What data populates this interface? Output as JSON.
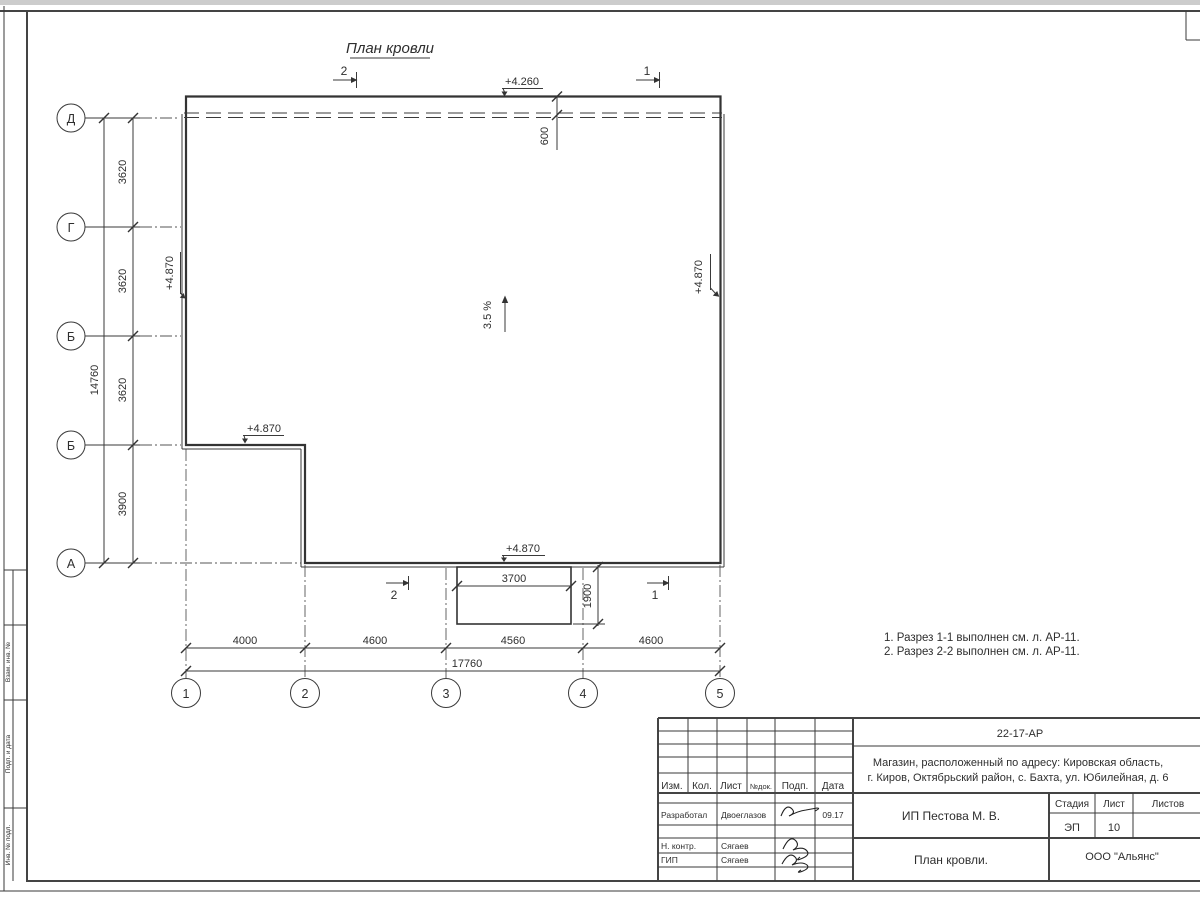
{
  "frame": {
    "side_labels": [
      "Взам. инв. №",
      "Подп. и дата",
      "Инв. № подл."
    ]
  },
  "drawing": {
    "title": "План кровли",
    "slope": "3.5 %",
    "notes": [
      "1. Разрез 1-1 выполнен см. л. АР-11.",
      "2. Разрез 2-2 выполнен см. л. АР-11."
    ],
    "axes_rows": [
      "Д",
      "Г",
      "Б",
      "Б",
      "А"
    ],
    "axes_cols": [
      "1",
      "2",
      "3",
      "4",
      "5"
    ],
    "sections": {
      "s1": "1",
      "s2": "2"
    },
    "elevations": {
      "top": "+4.260",
      "left": "+4.870",
      "right": "+4.870",
      "notch": "+4.870",
      "bottom": "+4.870"
    },
    "dims": {
      "left_segments": [
        "3620",
        "3620",
        "3620",
        "3900"
      ],
      "left_total": "14760",
      "bottom_segments": [
        "4000",
        "4600",
        "4560",
        "4600"
      ],
      "bottom_total": "17760",
      "overhang": "600",
      "canopy_width": "3700",
      "canopy_depth": "1900"
    }
  },
  "title_block": {
    "doc_number": "22-17-АР",
    "address_line1": "Магазин, расположенный по адресу: Кировская область,",
    "address_line2": "г. Киров, Октябрьский район, с. Бахта, ул. Юбилейная, д. 6",
    "client": "ИП Пестова М. В.",
    "sheet_title": "План кровли.",
    "company": "ООО \"Альянс\"",
    "stage_label": "Стадия",
    "sheet_label": "Лист",
    "sheets_label": "Листов",
    "stage": "ЭП",
    "sheet_no": "10",
    "cols": {
      "izm": "Изм.",
      "kol": "Кол.",
      "list": "Лист",
      "doc": "№док.",
      "podp": "Подп.",
      "data": "Дата"
    },
    "roles": [
      {
        "role": "Разработал",
        "name": "Двоеглазов",
        "date": "09.17"
      },
      {
        "role": "Н. контр.",
        "name": "Сягаев",
        "date": ""
      },
      {
        "role": "ГИП",
        "name": "Сягаев",
        "date": ""
      }
    ]
  }
}
